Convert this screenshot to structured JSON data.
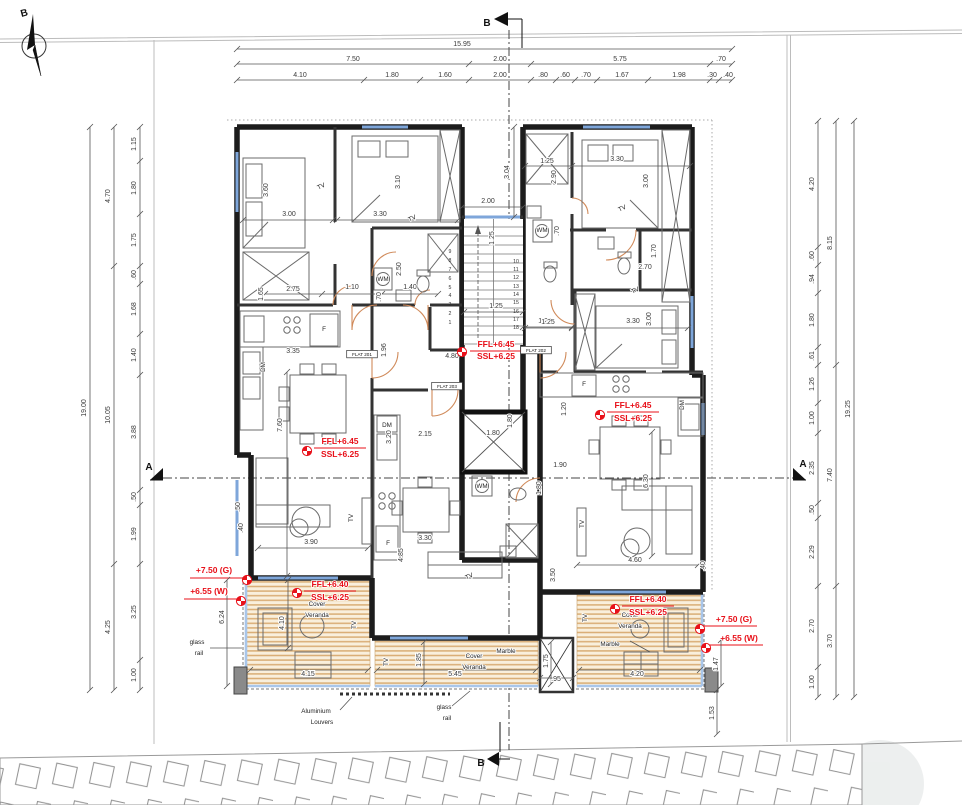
{
  "drawing": {
    "compass_letter": "B",
    "section_markers": {
      "top": "B",
      "bottom": "B",
      "left": "A",
      "right": "A"
    },
    "flats": [
      "FLAT 201",
      "FLAT 202",
      "FLAT 203"
    ],
    "level_annotations": [
      "FFL+6.45",
      "SSL+6.25",
      "FFL+6.40",
      "+7.50 (G)",
      "+6.55 (W)"
    ],
    "material_labels": [
      "Cover Veranda",
      "Marble",
      "glass rail",
      "Aluminium Louvers"
    ],
    "appliance_labels": [
      "TV",
      "F",
      "DM",
      "WM"
    ]
  },
  "plan": {
    "texts": [
      [
        "15.95",
        462,
        46,
        0,
        "d"
      ],
      [
        "7.50",
        353,
        61,
        0,
        "d"
      ],
      [
        "2.00",
        500,
        61,
        0,
        "d"
      ],
      [
        "5.75",
        620,
        61,
        0,
        "d"
      ],
      [
        ".70",
        721,
        61,
        0,
        "d"
      ],
      [
        "4.10",
        300,
        77,
        0,
        "d"
      ],
      [
        "1.80",
        392,
        77,
        0,
        "d"
      ],
      [
        "1.60",
        445,
        77,
        0,
        "d"
      ],
      [
        "2.00",
        500,
        77,
        0,
        "d"
      ],
      [
        ".80",
        543,
        77,
        0,
        "d"
      ],
      [
        ".60",
        565,
        77,
        0,
        "d"
      ],
      [
        ".70",
        586,
        77,
        0,
        "d"
      ],
      [
        "1.67",
        622,
        77,
        0,
        "d"
      ],
      [
        "1.98",
        679,
        77,
        0,
        "d"
      ],
      [
        ".30",
        712,
        77,
        0,
        "d"
      ],
      [
        ".40",
        728,
        77,
        0,
        "d"
      ],
      [
        "1.15",
        136,
        144,
        -90,
        "d"
      ],
      [
        "1.80",
        136,
        188,
        -90,
        "d"
      ],
      [
        "1.75",
        136,
        240,
        -90,
        "d"
      ],
      [
        ".60",
        136,
        275,
        -90,
        "d"
      ],
      [
        "1.68",
        136,
        309,
        -90,
        "d"
      ],
      [
        "1.40",
        136,
        355,
        -90,
        "d"
      ],
      [
        "3.88",
        136,
        432,
        -90,
        "d"
      ],
      [
        ".50",
        136,
        497,
        -90,
        "d"
      ],
      [
        "1.99",
        136,
        534,
        -90,
        "d"
      ],
      [
        "3.25",
        136,
        612,
        -90,
        "d"
      ],
      [
        "1.00",
        136,
        675,
        -90,
        "d"
      ],
      [
        "4.70",
        110,
        196,
        -90,
        "d"
      ],
      [
        "10.05",
        110,
        415,
        -90,
        "d"
      ],
      [
        "4.25",
        110,
        627,
        -90,
        "d"
      ],
      [
        "19.00",
        86,
        408,
        -90,
        "d"
      ],
      [
        "4.20",
        814,
        184,
        -90,
        "d"
      ],
      [
        ".60",
        814,
        256,
        -90,
        "d"
      ],
      [
        ".94",
        814,
        279,
        -90,
        "d"
      ],
      [
        "1.80",
        814,
        320,
        -90,
        "d"
      ],
      [
        ".61",
        814,
        356,
        -90,
        "d"
      ],
      [
        "1.26",
        814,
        384,
        -90,
        "d"
      ],
      [
        "1.00",
        814,
        418,
        -90,
        "d"
      ],
      [
        "2.35",
        814,
        468,
        -90,
        "d"
      ],
      [
        ".50",
        814,
        510,
        -90,
        "d"
      ],
      [
        "2.29",
        814,
        552,
        -90,
        "d"
      ],
      [
        "2.70",
        814,
        626,
        -90,
        "d"
      ],
      [
        "1.00",
        814,
        682,
        -90,
        "d"
      ],
      [
        "8.15",
        832,
        243,
        -90,
        "d"
      ],
      [
        "7.40",
        832,
        475,
        -90,
        "d"
      ],
      [
        "3.70",
        832,
        641,
        -90,
        "d"
      ],
      [
        "19.25",
        850,
        409,
        -90,
        "d"
      ],
      [
        "3.00",
        289,
        216,
        0,
        "d"
      ],
      [
        "3.60",
        268,
        190,
        -90,
        "d"
      ],
      [
        "3.30",
        380,
        216,
        0,
        "d"
      ],
      [
        "3.10",
        400,
        182,
        -90,
        "d"
      ],
      [
        "1.65",
        263,
        294,
        -90,
        "d"
      ],
      [
        "2.75",
        293,
        291,
        0,
        "d"
      ],
      [
        "1.10",
        352,
        289,
        0,
        "d"
      ],
      [
        "1.40",
        410,
        289,
        0,
        "d"
      ],
      [
        ".70",
        381,
        297,
        -90,
        "d"
      ],
      [
        "2.50",
        401,
        269,
        -90,
        "d"
      ],
      [
        "1.96",
        386,
        350,
        -90,
        "d"
      ],
      [
        "3.35",
        293,
        353,
        0,
        "d"
      ],
      [
        "4.80",
        452,
        358,
        0,
        "d"
      ],
      [
        "2.00",
        488,
        203,
        0,
        "d"
      ],
      [
        "3.04",
        509,
        172,
        -90,
        "d"
      ],
      [
        "1.25",
        494,
        238,
        -90,
        "d"
      ],
      [
        "1.25",
        496,
        308,
        0,
        "d"
      ],
      [
        "1.25",
        545,
        323,
        0,
        "d"
      ],
      [
        "7.60",
        282,
        425,
        -90,
        "d"
      ],
      [
        "3.90",
        311,
        544,
        0,
        "d"
      ],
      [
        ".40",
        243,
        528,
        -90,
        "d"
      ],
      [
        "3.20",
        391,
        437,
        -90,
        "d"
      ],
      [
        "2.15",
        425,
        436,
        0,
        "d"
      ],
      [
        "3.30",
        425,
        540,
        0,
        "d"
      ],
      [
        "4.85",
        403,
        555,
        -90,
        "d"
      ],
      [
        "1.80",
        493,
        435,
        0,
        "d"
      ],
      [
        "1.80",
        512,
        421,
        -90,
        "d"
      ],
      [
        "1.25",
        547,
        163,
        0,
        "d"
      ],
      [
        "3.30",
        617,
        161,
        0,
        "d"
      ],
      [
        "2.90",
        556,
        177,
        -90,
        "d"
      ],
      [
        "3.00",
        648,
        181,
        -90,
        "d"
      ],
      [
        ".70",
        559,
        231,
        -90,
        "d"
      ],
      [
        "1.70",
        656,
        251,
        -90,
        "d"
      ],
      [
        "2.70",
        645,
        269,
        0,
        "d"
      ],
      [
        "1.25",
        548,
        324,
        0,
        "d"
      ],
      [
        "3.30",
        633,
        323,
        0,
        "d"
      ],
      [
        "3.00",
        651,
        319,
        -90,
        "d"
      ],
      [
        "1.20",
        566,
        409,
        -90,
        "d"
      ],
      [
        "6.30",
        648,
        481,
        -90,
        "d"
      ],
      [
        "1.90",
        560,
        467,
        0,
        "d"
      ],
      [
        "1.80",
        541,
        488,
        -90,
        "d"
      ],
      [
        "4.60",
        635,
        562,
        0,
        "d"
      ],
      [
        ".40",
        705,
        566,
        -90,
        "d"
      ],
      [
        "3.50",
        555,
        575,
        -90,
        "d"
      ],
      [
        "6.24",
        224,
        617,
        -90,
        "d"
      ],
      [
        ".50",
        240,
        507,
        -90,
        "d"
      ],
      [
        "4.10",
        284,
        623,
        -90,
        "d"
      ],
      [
        "4.15",
        308,
        676,
        0,
        "d"
      ],
      [
        "1.85",
        421,
        660,
        -90,
        "d"
      ],
      [
        "5.45",
        455,
        676,
        0,
        "d"
      ],
      [
        "1.75",
        548,
        661,
        -90,
        "d"
      ],
      [
        ".95",
        556,
        681,
        0,
        "d"
      ],
      [
        "4.20",
        637,
        676,
        0,
        "d"
      ],
      [
        "1.47",
        718,
        664,
        -90,
        "d"
      ],
      [
        "1.53",
        714,
        713,
        -90,
        "d"
      ],
      [
        "1",
        450,
        324,
        0,
        "t"
      ],
      [
        "2",
        450,
        315,
        0,
        "t"
      ],
      [
        "3",
        450,
        306,
        0,
        "t"
      ],
      [
        "4",
        450,
        297,
        0,
        "t"
      ],
      [
        "5",
        450,
        289,
        0,
        "t"
      ],
      [
        "6",
        450,
        280,
        0,
        "t"
      ],
      [
        "7",
        450,
        271,
        0,
        "t"
      ],
      [
        "8",
        450,
        262,
        0,
        "t"
      ],
      [
        "9",
        450,
        253,
        0,
        "t"
      ],
      [
        "10",
        516,
        263,
        0,
        "t"
      ],
      [
        "11",
        516,
        271,
        0,
        "t"
      ],
      [
        "12",
        516,
        279,
        0,
        "t"
      ],
      [
        "13",
        516,
        288,
        0,
        "t"
      ],
      [
        "14",
        516,
        296,
        0,
        "t"
      ],
      [
        "15",
        516,
        304,
        0,
        "t"
      ],
      [
        "16",
        516,
        313,
        0,
        "t"
      ],
      [
        "17",
        516,
        321,
        0,
        "t"
      ],
      [
        "18",
        516,
        329,
        0,
        "t"
      ],
      [
        "TV",
        322,
        188,
        -25,
        "l"
      ],
      [
        "TV",
        413,
        220,
        -25,
        "l"
      ],
      [
        "TV",
        623,
        210,
        -25,
        "l"
      ],
      [
        "TV",
        636,
        292,
        -25,
        "l"
      ],
      [
        "TV",
        353,
        518,
        -90,
        "l"
      ],
      [
        "TV",
        584,
        524,
        -90,
        "l"
      ],
      [
        "TV",
        470,
        578,
        -25,
        "l"
      ],
      [
        "TV",
        356,
        625,
        -90,
        "l"
      ],
      [
        "TV",
        388,
        662,
        -90,
        "l"
      ],
      [
        "TV",
        587,
        618,
        -90,
        "l"
      ],
      [
        "F",
        324,
        331,
        0,
        "l"
      ],
      [
        "F",
        388,
        545,
        0,
        "l"
      ],
      [
        "F",
        584,
        386,
        0,
        "l"
      ],
      [
        "DM",
        265,
        367,
        -90,
        "l"
      ],
      [
        "DM",
        387,
        427,
        0,
        "l"
      ],
      [
        "DM",
        684,
        405,
        -90,
        "l"
      ],
      [
        "WM",
        383,
        281,
        0,
        "l"
      ],
      [
        "WM",
        542,
        232,
        0,
        "l"
      ],
      [
        "WM",
        482,
        488,
        0,
        "l"
      ],
      [
        "Cover",
        317,
        606,
        0,
        "l"
      ],
      [
        "Veranda",
        317,
        617,
        0,
        "l"
      ],
      [
        "Cover",
        474,
        658,
        0,
        "l"
      ],
      [
        "Veranda",
        474,
        669,
        0,
        "l"
      ],
      [
        "Cover",
        630,
        617,
        0,
        "l"
      ],
      [
        "Veranda",
        630,
        628,
        0,
        "l"
      ],
      [
        "Marble",
        506,
        653,
        0,
        "l"
      ],
      [
        "Marble",
        610,
        646,
        0,
        "l"
      ],
      [
        "glass",
        197,
        644,
        0,
        "l"
      ],
      [
        "rail",
        199,
        655,
        0,
        "l"
      ],
      [
        "glass",
        444,
        709,
        0,
        "l"
      ],
      [
        "rail",
        447,
        720,
        0,
        "l"
      ],
      [
        "Aluminium",
        316,
        713,
        0,
        "l"
      ],
      [
        "Louvers",
        322,
        724,
        0,
        "l"
      ],
      [
        "FLAT 201",
        362,
        356,
        0,
        "f"
      ],
      [
        "FLAT 203",
        447,
        388,
        0,
        "f"
      ],
      [
        "FLAT 202",
        536,
        352,
        0,
        "f"
      ],
      [
        "FFL+6.45",
        496,
        347,
        0,
        "r"
      ],
      [
        "SSL+6.25",
        496,
        359,
        0,
        "r"
      ],
      [
        "FFL+6.45",
        340,
        444,
        0,
        "r"
      ],
      [
        "SSL+6.25",
        340,
        457,
        0,
        "r"
      ],
      [
        "FFL+6.45",
        633,
        408,
        0,
        "r"
      ],
      [
        "SSL+6.25",
        633,
        421,
        0,
        "r"
      ],
      [
        "FFL+6.40",
        330,
        587,
        0,
        "r"
      ],
      [
        "SSL+6.25",
        330,
        600,
        0,
        "r"
      ],
      [
        "FFL+6.40",
        648,
        602,
        0,
        "r"
      ],
      [
        "SSL+6.25",
        648,
        615,
        0,
        "r"
      ],
      [
        "+7.50 (G)",
        214,
        573,
        0,
        "r"
      ],
      [
        "+6.55 (W)",
        209,
        594,
        0,
        "r"
      ],
      [
        "+7.50 (G)",
        734,
        622,
        0,
        "r"
      ],
      [
        "+6.55 (W)",
        739,
        641,
        0,
        "r"
      ],
      [
        "B",
        487,
        26,
        0,
        "s"
      ],
      [
        "B",
        481,
        766,
        0,
        "s"
      ],
      [
        "A",
        149,
        470,
        0,
        "s"
      ],
      [
        "A",
        803,
        467,
        0,
        "s"
      ],
      [
        "B",
        25,
        16,
        -15,
        "s"
      ]
    ]
  }
}
